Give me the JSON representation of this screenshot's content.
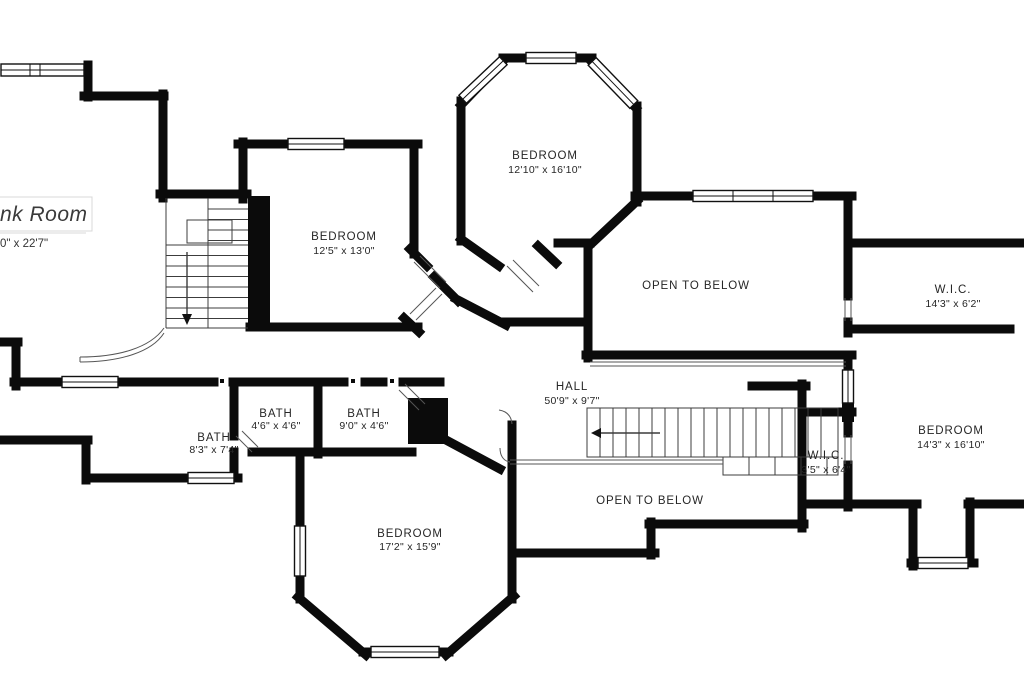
{
  "plan": {
    "type": "floor-plan",
    "background_color": "#ffffff",
    "wall_color": "#0b0b0b",
    "rooms": [
      {
        "id": "bunk-room",
        "name": "nk Room",
        "dims": "0\" x 22'7\"",
        "note": "label cut off at left edge"
      },
      {
        "id": "bedroom-upper-left",
        "name": "BEDROOM",
        "dims": "12'5\" x 13'0\""
      },
      {
        "id": "bedroom-top-center",
        "name": "BEDROOM",
        "dims": "12'10\" x 16'10\""
      },
      {
        "id": "open-to-below-right",
        "name": "OPEN TO BELOW",
        "dims": ""
      },
      {
        "id": "wic-right",
        "name": "W.I.C.",
        "dims": "14'3\" x 6'2\""
      },
      {
        "id": "hall",
        "name": "HALL",
        "dims": "50'9\" x 9'7\""
      },
      {
        "id": "bath-left",
        "name": "BATH",
        "dims": "8'3\" x 7'4\""
      },
      {
        "id": "bath-middle",
        "name": "BATH",
        "dims": "4'6\" x 4'6\""
      },
      {
        "id": "bath-right",
        "name": "BATH",
        "dims": "9'0\" x 4'6\""
      },
      {
        "id": "bedroom-bottom",
        "name": "BEDROOM",
        "dims": "17'2\" x 15'9\""
      },
      {
        "id": "open-to-below-bottom",
        "name": "OPEN TO BELOW",
        "dims": ""
      },
      {
        "id": "wic-bottom",
        "name": "W.I.C.",
        "dims": "3'5\" x 6'4\""
      },
      {
        "id": "bedroom-bottom-right",
        "name": "BEDROOM",
        "dims": "14'3\" x 16'10\""
      }
    ],
    "features": {
      "staircases": [
        "u-shaped staircase upper-left with down arrow",
        "straight staircase in hall with left arrow"
      ],
      "open_areas": 2,
      "windows": 12,
      "railings": [
        "curved railing near upper stairs",
        "railing along open-to-below edges"
      ]
    }
  }
}
